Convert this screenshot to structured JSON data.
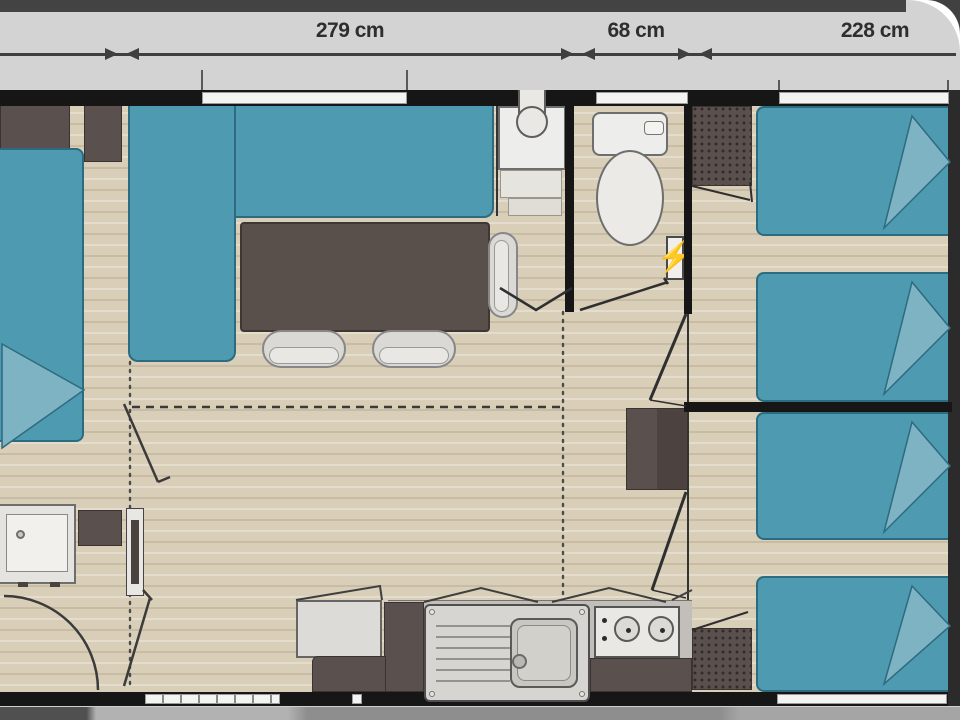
{
  "meta": {
    "type": "floor-plan",
    "description": "Mobile home floor plan, top view, with exterior dimension bar"
  },
  "colors": {
    "accent_teal": "#4E9BB1",
    "teal_border": "#2D6B80",
    "teal_light": "#7DB3C3",
    "wall_black": "#161616",
    "floor": "#D9CEB8",
    "dark_furniture": "#5A504D",
    "band_bg": "#D3D3D3",
    "band_strip": "#434343",
    "label_text": "#2E2E2E",
    "fixture_white": "#EDEDEB",
    "fixture_border": "#6E6E6E",
    "counter_gray": "#C2BFBA",
    "bottom_strip": "#9A9A9A"
  },
  "dimension_bar": {
    "segments": [
      {
        "label": "279 cm"
      },
      {
        "label": "68 cm"
      },
      {
        "label": "228 cm"
      }
    ]
  },
  "icons": {
    "lightning": "⚡"
  }
}
